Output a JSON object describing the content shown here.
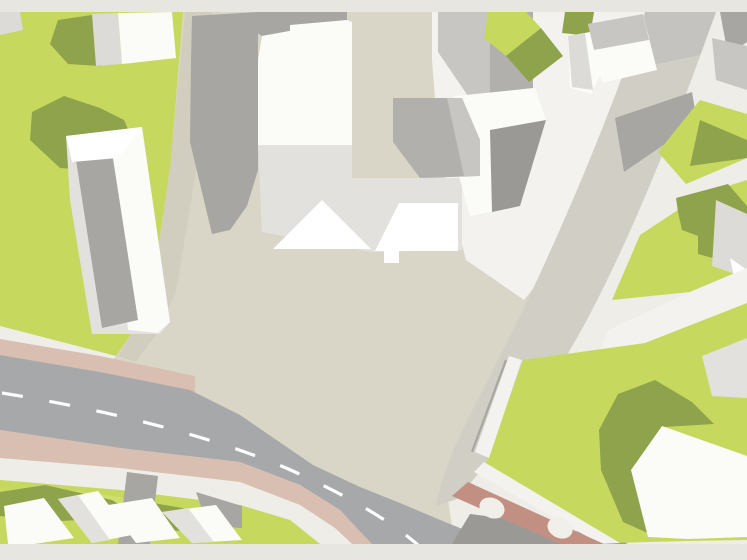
{
  "scene": {
    "type": "aerial-site-plan",
    "description": "Top-down 2D architectural site-plan map: beige central plaza, large white building complex with cast shadows, green lawns with residential buildings, a main road with dashed centerline and pink side strips, a curved side street, and a brick wall with two arches",
    "road": {
      "dash_count": 9,
      "pink_strip_count": 2
    },
    "wall": {
      "arch_count": 2
    }
  },
  "features": [
    {
      "id": "plaza",
      "label": "Central plaza"
    },
    {
      "id": "left-field",
      "label": "Western green field"
    },
    {
      "id": "main-road",
      "label": "Main road with dashed centerline"
    },
    {
      "id": "side-street",
      "label": "Curved side street (north-east to south)"
    },
    {
      "id": "central-building-complex",
      "label": "Large white building complex"
    },
    {
      "id": "west-building",
      "label": "West building with roof facets"
    },
    {
      "id": "northwest-building",
      "label": "North-west building"
    },
    {
      "id": "northeast-buildings",
      "label": "North-east buildings"
    },
    {
      "id": "east-lawns",
      "label": "Eastern lawns with buildings"
    },
    {
      "id": "southeast-lawn",
      "label": "South-east lawn with large building"
    },
    {
      "id": "southwest-houses",
      "label": "South-west row of houses"
    },
    {
      "id": "arched-wall",
      "label": "Brick wall with arches"
    }
  ],
  "colors": {
    "frame_band": "#e8e6e1",
    "plaza": "#d9d6c7",
    "plaza_lane": "#d1cec0",
    "right_base": "#eeede8",
    "street": "#d0cec5",
    "street_shade": "#c4c3bf",
    "sidewalk": "#f3f2ee",
    "grass": "#c7d85f",
    "grass_bright": "#cfdf6f",
    "grass_shadow": "#8ea34b",
    "shadow_gray": "#a7a6a2",
    "shadow_dark": "#9a9995",
    "white": "#ffffff",
    "roof_white": "#fbfbf8",
    "roof_light": "#e2e1dd",
    "roof_mid": "#c7c6c2",
    "roof_gray": "#b1b0ac",
    "bldg_lightgray": "#dcdbd7",
    "asphalt": "#a7a8aa",
    "lane_dash": "#fdfdfd",
    "path_pink": "#d9bfb1",
    "brick": "#c19083",
    "arch": "#f1efe9"
  }
}
